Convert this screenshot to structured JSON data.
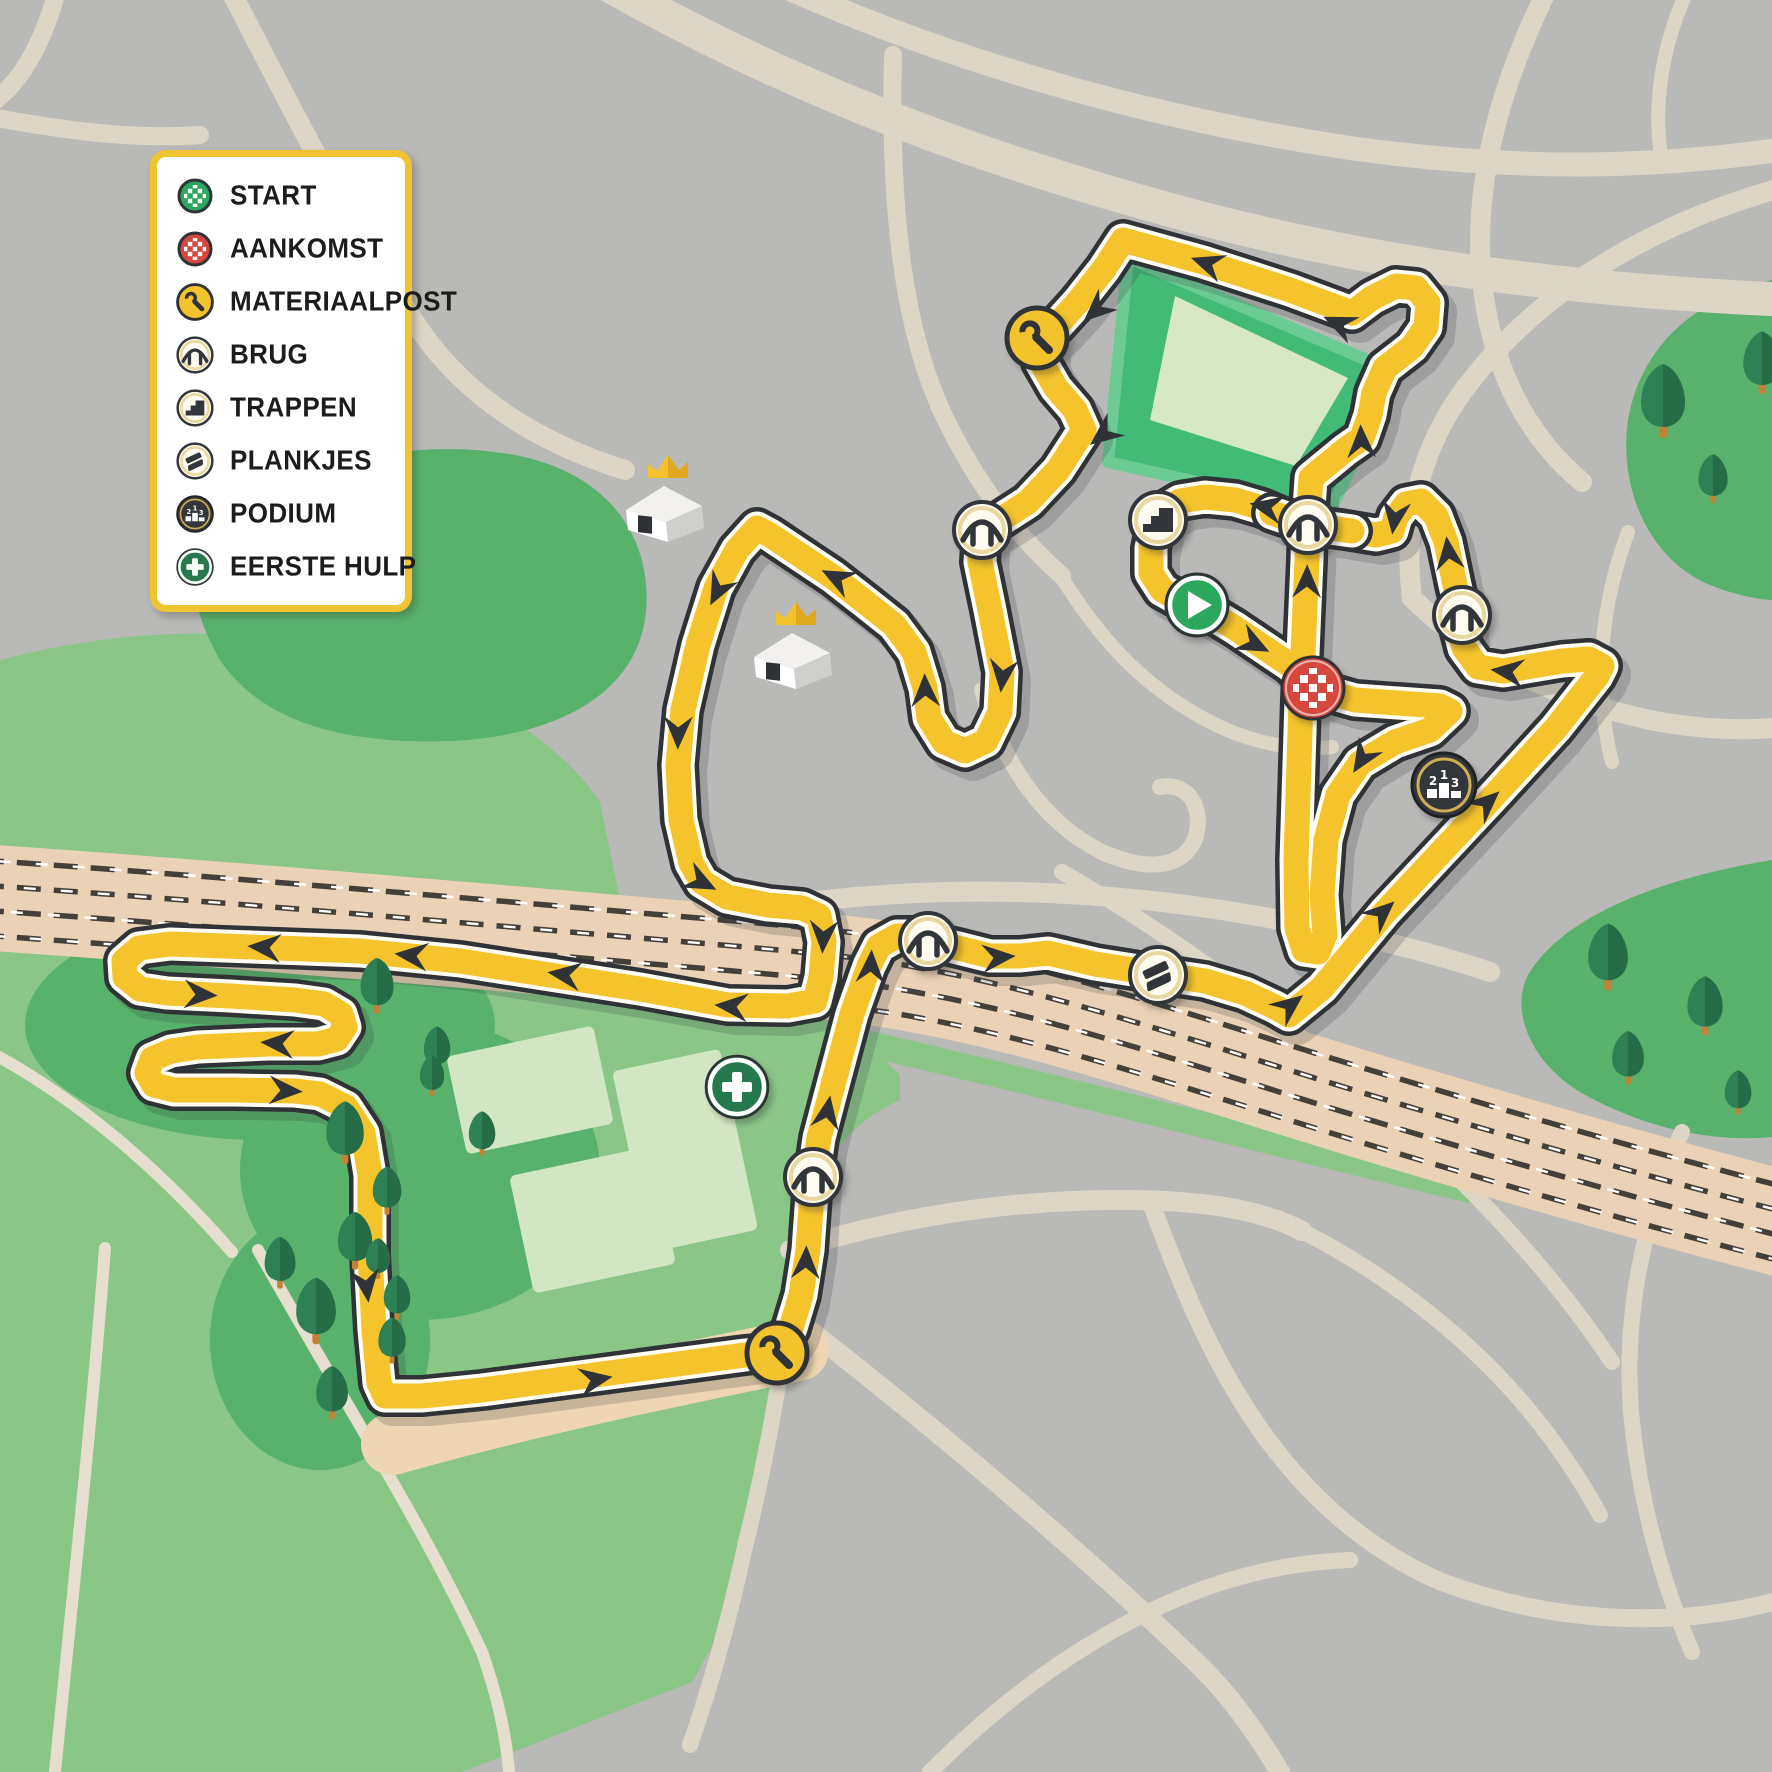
{
  "legend": {
    "items": [
      {
        "icon": "start",
        "label": "START"
      },
      {
        "icon": "aankomst",
        "label": "AANKOMST"
      },
      {
        "icon": "materiaalpost",
        "label": "MATERIAALPOST"
      },
      {
        "icon": "brug",
        "label": "BRUG"
      },
      {
        "icon": "trappen",
        "label": "TRAPPEN"
      },
      {
        "icon": "plankjes",
        "label": "PLANKJES"
      },
      {
        "icon": "podium",
        "label": "PODIUM"
      },
      {
        "icon": "eerste-hulp",
        "label": "EERSTE HULP"
      }
    ]
  },
  "map": {
    "podium_numbers": [
      "2",
      "1",
      "3"
    ],
    "course_icons": [
      {
        "type": "materiaalpost",
        "x": 1037,
        "y": 338
      },
      {
        "type": "brug",
        "x": 982,
        "y": 530
      },
      {
        "type": "trappen",
        "x": 1158,
        "y": 520
      },
      {
        "type": "brug",
        "x": 1308,
        "y": 525
      },
      {
        "type": "start",
        "x": 1197,
        "y": 605
      },
      {
        "type": "brug",
        "x": 1462,
        "y": 615
      },
      {
        "type": "aankomst",
        "x": 1313,
        "y": 688
      },
      {
        "type": "podium",
        "x": 1444,
        "y": 785
      },
      {
        "type": "brug",
        "x": 928,
        "y": 941
      },
      {
        "type": "plankjes",
        "x": 1158,
        "y": 975
      },
      {
        "type": "eerste-hulp",
        "x": 737,
        "y": 1087
      },
      {
        "type": "brug",
        "x": 813,
        "y": 1177
      },
      {
        "type": "materiaalpost",
        "x": 777,
        "y": 1353
      }
    ],
    "arrows": [
      {
        "x": 1203,
        "y": 262,
        "a": 199
      },
      {
        "x": 1335,
        "y": 322,
        "a": 204
      },
      {
        "x": 1093,
        "y": 313,
        "a": 138
      },
      {
        "x": 1100,
        "y": 437,
        "a": 142
      },
      {
        "x": 1002,
        "y": 680,
        "a": 96
      },
      {
        "x": 925,
        "y": 686,
        "a": 268
      },
      {
        "x": 833,
        "y": 576,
        "a": 207
      },
      {
        "x": 716,
        "y": 594,
        "a": 117
      },
      {
        "x": 678,
        "y": 737,
        "a": 91
      },
      {
        "x": 705,
        "y": 884,
        "a": 27
      },
      {
        "x": 823,
        "y": 941,
        "a": 93
      },
      {
        "x": 727,
        "y": 1006,
        "a": 185
      },
      {
        "x": 560,
        "y": 974,
        "a": 188
      },
      {
        "x": 407,
        "y": 955,
        "a": 186
      },
      {
        "x": 260,
        "y": 947,
        "a": 184
      },
      {
        "x": 205,
        "y": 995,
        "a": 3
      },
      {
        "x": 273,
        "y": 1043,
        "a": 184
      },
      {
        "x": 290,
        "y": 1091,
        "a": 3
      },
      {
        "x": 367,
        "y": 1290,
        "a": 83
      },
      {
        "x": 600,
        "y": 1379,
        "a": 350
      },
      {
        "x": 806,
        "y": 1258,
        "a": 272
      },
      {
        "x": 828,
        "y": 1108,
        "a": 280
      },
      {
        "x": 871,
        "y": 962,
        "a": 273
      },
      {
        "x": 1003,
        "y": 957,
        "a": 355
      },
      {
        "x": 1293,
        "y": 1003,
        "a": 322
      },
      {
        "x": 1385,
        "y": 910,
        "a": 318
      },
      {
        "x": 1490,
        "y": 800,
        "a": 318
      },
      {
        "x": 1503,
        "y": 671,
        "a": 187
      },
      {
        "x": 1448,
        "y": 549,
        "a": 263
      },
      {
        "x": 1394,
        "y": 522,
        "a": 98
      },
      {
        "x": 1262,
        "y": 506,
        "a": 192
      },
      {
        "x": 1258,
        "y": 646,
        "a": 27
      },
      {
        "x": 1360,
        "y": 762,
        "a": 122
      },
      {
        "x": 1307,
        "y": 577,
        "a": 271
      },
      {
        "x": 1361,
        "y": 437,
        "a": 268
      }
    ],
    "trees": [
      {
        "x": 377,
        "y": 985,
        "s": 0.75
      },
      {
        "x": 437,
        "y": 1048,
        "s": 0.6
      },
      {
        "x": 345,
        "y": 1132,
        "s": 0.85
      },
      {
        "x": 387,
        "y": 1190,
        "s": 0.65
      },
      {
        "x": 482,
        "y": 1133,
        "s": 0.6
      },
      {
        "x": 355,
        "y": 1240,
        "s": 0.78
      },
      {
        "x": 397,
        "y": 1297,
        "s": 0.6
      },
      {
        "x": 280,
        "y": 1262,
        "s": 0.7
      },
      {
        "x": 316,
        "y": 1310,
        "s": 0.9
      },
      {
        "x": 332,
        "y": 1392,
        "s": 0.72
      },
      {
        "x": 378,
        "y": 1258,
        "s": 0.55
      },
      {
        "x": 392,
        "y": 1340,
        "s": 0.62
      },
      {
        "x": 432,
        "y": 1075,
        "s": 0.55
      },
      {
        "x": 1608,
        "y": 956,
        "s": 0.9
      },
      {
        "x": 1628,
        "y": 1057,
        "s": 0.72
      },
      {
        "x": 1705,
        "y": 1005,
        "s": 0.8
      },
      {
        "x": 1738,
        "y": 1092,
        "s": 0.6
      },
      {
        "x": 1663,
        "y": 400,
        "s": 1.0
      },
      {
        "x": 1713,
        "y": 478,
        "s": 0.66
      },
      {
        "x": 1762,
        "y": 362,
        "s": 0.85
      }
    ],
    "houses": [
      {
        "x": 664,
        "y": 506
      },
      {
        "x": 792,
        "y": 653
      }
    ],
    "colors": {
      "background_gray": "#b9b9b7",
      "road_beige": "#ddd6c7",
      "railway_tan": "#ead2b6",
      "park_green": "#8ac787",
      "park_dark_green": "#58b26c",
      "stadium_green": "#41bb77",
      "stadium_inner": "#d6e8c8",
      "course_yellow": "#f5c42c",
      "course_outline": "#2f3337",
      "start_green": "#2ba85c",
      "finish_red": "#d6473d",
      "firstaid_green": "#26794f",
      "icon_cream": "#fefcf0",
      "legend_border": "#f0c330",
      "crown_gold": "#f3c32e",
      "tree_green": "#2d8154",
      "trunk_brown": "#c08236"
    }
  }
}
